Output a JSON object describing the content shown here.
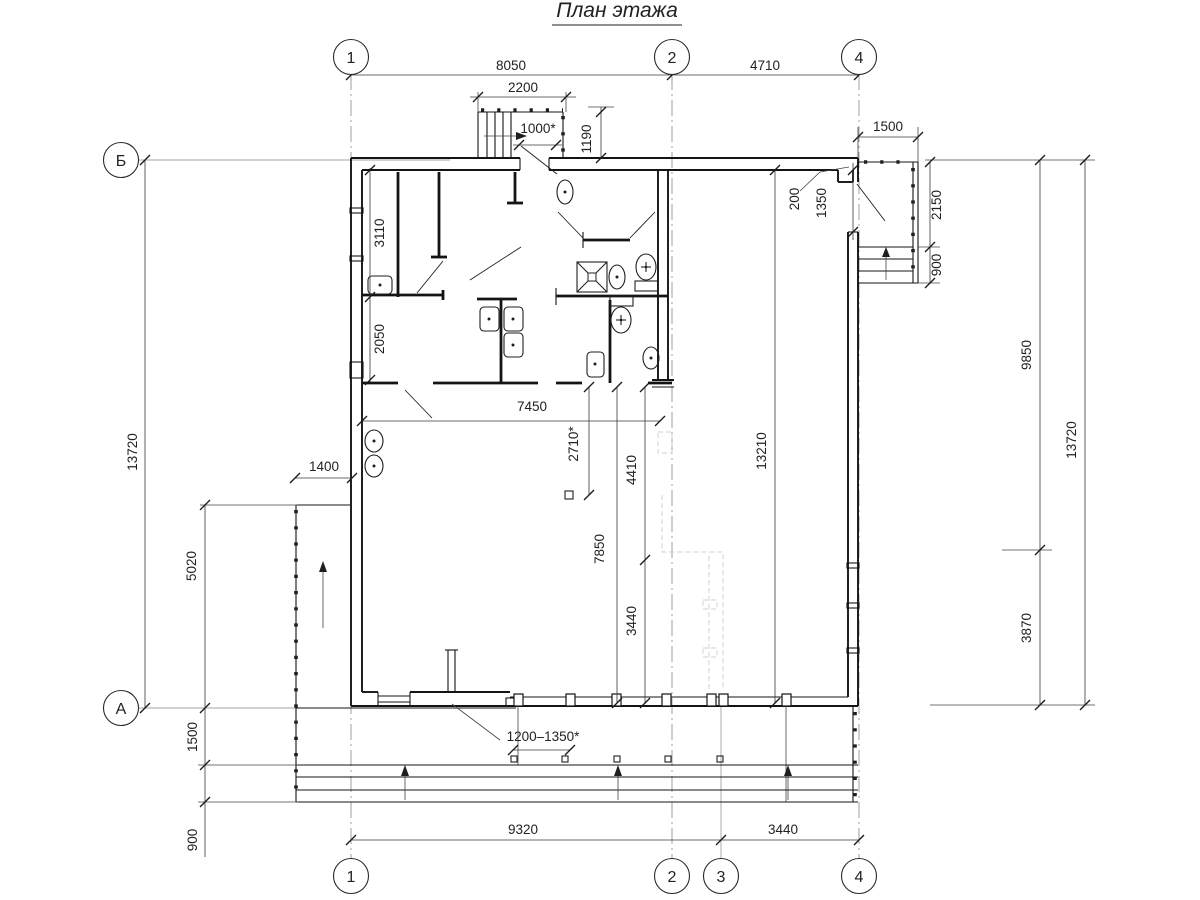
{
  "title": "План этажа",
  "grid": {
    "axis_1": "1",
    "axis_2": "2",
    "axis_3": "3",
    "axis_4": "4",
    "axis_a": "А",
    "axis_b": "Б"
  },
  "dimensions": {
    "span_1_2": "8050",
    "span_2_4": "4710",
    "stair_width": "2200",
    "entry_width": "1000*",
    "entry_depth": "1190",
    "porch_width": "1500",
    "offset_200": "200",
    "porch_door": "1350",
    "porch_depth": "2150",
    "porch_steps": "900",
    "room_a_depth": "3110",
    "room_b_depth": "2050",
    "hall_width": "7450",
    "col_offset": "2710*",
    "ghost_top": "4410",
    "ghost_bottom": "3440",
    "hall_depth": "7850",
    "interior_depth": "13210",
    "ramp_width": "1400",
    "ramp_length": "5020",
    "total_left": "13720",
    "terrace_depth": "1500",
    "terrace_step": "900",
    "post_gap": "1200–1350*",
    "span_1_3": "9320",
    "span_3_4": "3440",
    "right_upper": "9850",
    "right_lower": "3870",
    "total_right": "13720"
  }
}
